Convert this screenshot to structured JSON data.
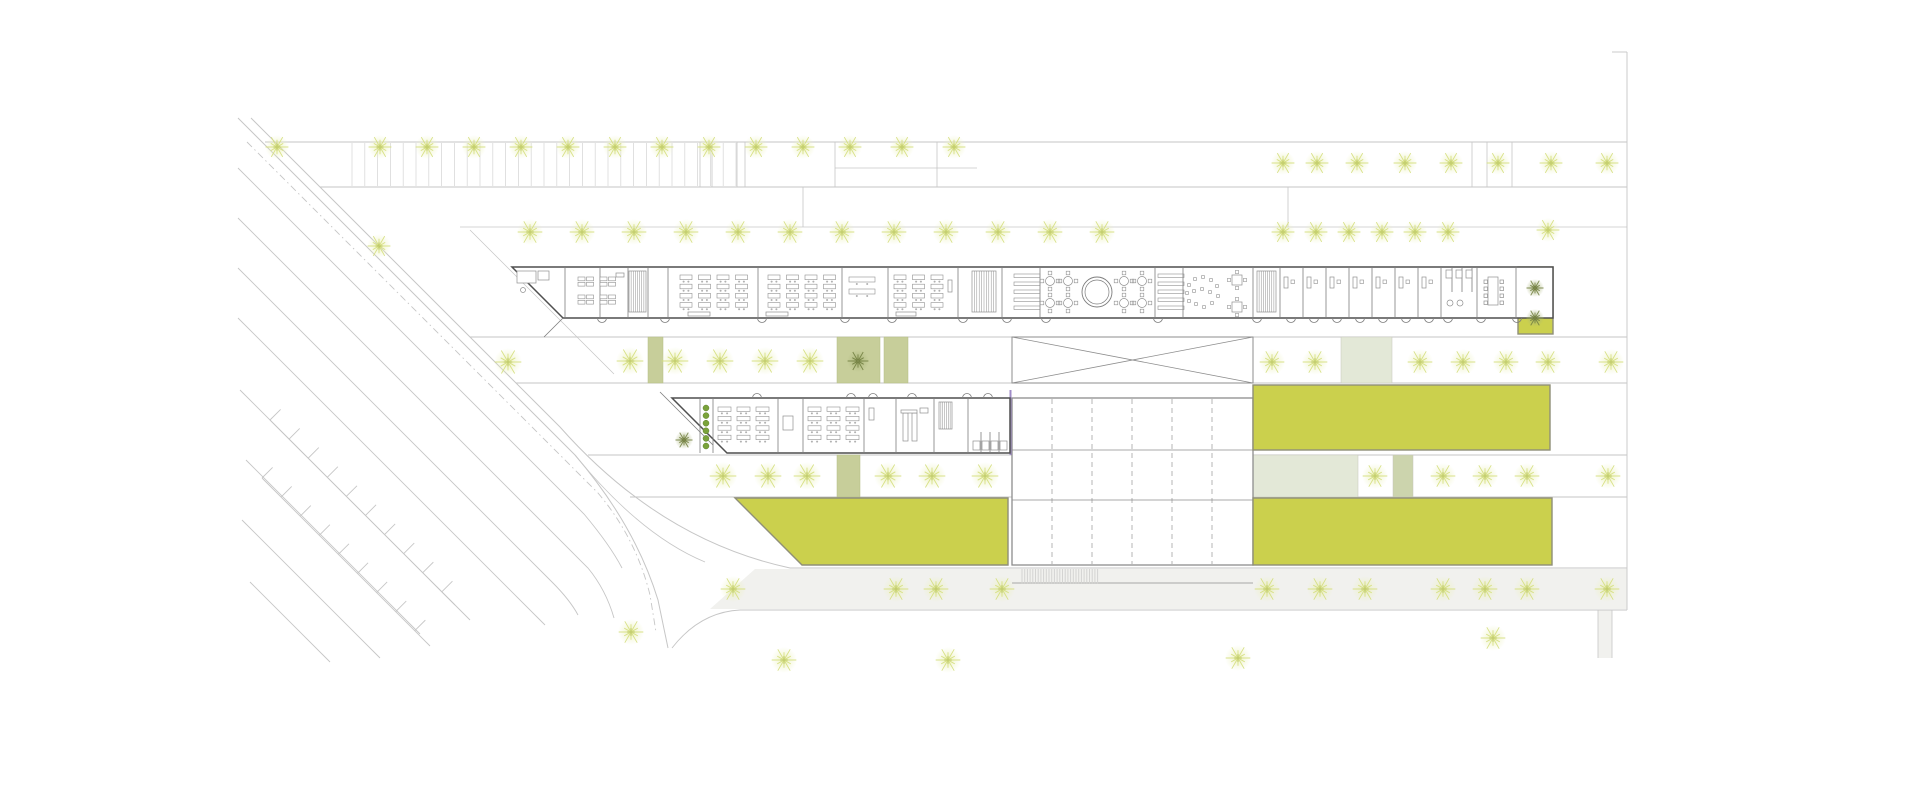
{
  "meta": {
    "canvas": {
      "width": 1920,
      "height": 800
    }
  },
  "palette": {
    "background": "#ffffff",
    "site_line": "#c6c6c6",
    "site_line_light": "#dadada",
    "hatch": "#d9d9d9",
    "crosswalk": "#d4d4d2",
    "wall_dark": "#4f4f4f",
    "wall_mid": "#7d7d7d",
    "furniture": "#8f8f8f",
    "hall_line": "#8d8d8d",
    "yellow_fill": "#cbd04d",
    "yellow_stroke": "#8f8f78",
    "sage_fill": "#c7ce9a",
    "sage_stroke": "#b5bd85",
    "pale_sage_fill": "#e3e8d7",
    "pale_sage_small": "#ccd4ad",
    "tree_light_ray": "#d4de7b",
    "tree_light_core": "#b8c457",
    "tree_dark_ray": "#727f41",
    "planter_dot": "#7aa33a",
    "planter_dot_edge": "#5f7f2c",
    "purple_accent": "#a08cc8",
    "road_band_fill": "#f1f1ee",
    "building_fill": "#ffffff"
  },
  "site": {
    "hlines": [
      [
        265,
        1627,
        142,
        0.9
      ],
      [
        320,
        1627,
        187,
        0.9
      ],
      [
        835,
        977,
        168,
        0.7
      ],
      [
        460,
        1627,
        227,
        0.8
      ],
      [
        470,
        1627,
        337,
        0.9
      ],
      [
        516,
        1627,
        383,
        0.9
      ],
      [
        588,
        1627,
        455,
        0.9
      ],
      [
        630,
        1627,
        497,
        0.9
      ],
      [
        790,
        1627,
        568,
        0.9
      ]
    ],
    "vlines": [
      [
        1627,
        52,
        610,
        0.9
      ],
      [
        700,
        142,
        187,
        0.8
      ],
      [
        712,
        142,
        187,
        0.8
      ],
      [
        737,
        142,
        187,
        0.8
      ],
      [
        745,
        142,
        187,
        0.8
      ],
      [
        835,
        142,
        187,
        0.8
      ],
      [
        937,
        142,
        187,
        0.8
      ],
      [
        1472,
        142,
        187,
        0.8
      ],
      [
        1487,
        142,
        187,
        0.8
      ],
      [
        1512,
        142,
        187,
        0.8
      ],
      [
        803,
        187,
        227,
        0.8
      ],
      [
        1288,
        187,
        227,
        0.8
      ],
      [
        1598,
        610,
        658,
        0.8
      ],
      [
        1612,
        610,
        658,
        0.8
      ]
    ],
    "paths": [
      {
        "d": "M251,118 L560,427 Q660,540 790,568",
        "w": 1.0
      },
      {
        "d": "M238,118 L575,455 Q635,525 658,600 L668,648",
        "w": 1.0
      },
      {
        "d": "M247,142 L598,493 Q636,538 650,595 L656,632",
        "w": 0.9,
        "dash": "7 3.5 1.5 3.5"
      },
      {
        "d": "M238,168 L584,514 Q610,545 622,568",
        "w": 0.9
      },
      {
        "d": "M238,218 L588,568 Q606,590 614,618",
        "w": 0.9
      },
      {
        "d": "M238,268 L552,582 Q570,600 578,615",
        "w": 0.9
      },
      {
        "d": "M238,318 L545,625",
        "w": 0.9
      },
      {
        "d": "M470,230 L614,374",
        "w": 0.7
      },
      {
        "d": "M575,455 Q640,535 705,562",
        "w": 0.8
      },
      {
        "d": "M1627,610 L740,610 Q700,612 672,648",
        "w": 0.9
      },
      {
        "d": "M240,390 L470,620",
        "w": 0.9
      },
      {
        "d": "M246,460 L420,634",
        "w": 0.9
      },
      {
        "d": "M242,520 L380,658",
        "w": 0.9
      },
      {
        "d": "M250,582 L330,662",
        "w": 0.9
      },
      {
        "d": "M1612,52 L1627,52",
        "w": 0.9
      }
    ],
    "tick_spines": [
      {
        "x1": 270,
        "y1": 420,
        "x2": 455,
        "y2": 605,
        "step": 27,
        "len": 15
      },
      {
        "x1": 262,
        "y1": 478,
        "x2": 430,
        "y2": 646,
        "step": 27,
        "len": 15
      }
    ],
    "parking_hatch": {
      "x1": 352,
      "x2": 737,
      "step": 12.8,
      "y1": 143,
      "y2": 186
    },
    "crosswalk": {
      "x1": 1022,
      "x2": 1098,
      "step": 2.7,
      "y1": 569,
      "y2": 584
    },
    "road_band_poly": "755,569 1627,569 1627,609 710,609",
    "side_path": {
      "x": 1598,
      "y": 610,
      "w": 14,
      "h": 48
    }
  },
  "blocks": {
    "sage": [
      {
        "x": 648,
        "y": 337,
        "w": 15,
        "h": 46
      },
      {
        "x": 837,
        "y": 337,
        "w": 43,
        "h": 46
      },
      {
        "x": 884,
        "y": 337,
        "w": 24,
        "h": 46
      },
      {
        "x": 837,
        "y": 455,
        "w": 23,
        "h": 42
      }
    ],
    "pale": [
      {
        "x": 1341,
        "y": 337,
        "w": 51,
        "h": 46,
        "f": "pale_sage_fill"
      },
      {
        "x": 1253,
        "y": 455,
        "w": 105,
        "h": 42,
        "f": "pale_sage_fill"
      },
      {
        "x": 1393,
        "y": 455,
        "w": 20,
        "h": 42,
        "f": "pale_sage_small"
      }
    ],
    "yellow_rects": [
      {
        "name": "lawn-upper-right",
        "x": 1253,
        "y": 385,
        "w": 297,
        "h": 65
      },
      {
        "name": "lawn-lower-right",
        "x": 1253,
        "y": 498,
        "w": 299,
        "h": 67
      },
      {
        "name": "courtyard-upper-east",
        "x": 1518,
        "y": 267,
        "w": 35,
        "h": 67
      }
    ],
    "yellow_polys": [
      {
        "name": "lawn-lower-left",
        "points": "735,498 1008,498 1008,565 802,565"
      }
    ]
  },
  "xramp": {
    "x": 1012,
    "y": 337,
    "w": 241,
    "h": 46
  },
  "hall": {
    "x": 1012,
    "y": 398,
    "w": 241,
    "h": 167,
    "dashed_cols": [
      1052,
      1092,
      1132,
      1172,
      1212
    ],
    "extra_hlines": [
      450,
      500,
      583
    ]
  },
  "purple_line": {
    "x": 1010.5,
    "y1": 390,
    "y2": 455
  },
  "upper_building": {
    "outline": "M512,267 L1553,267 L1553,318 L563,318 Z",
    "porch": "M563,318 L544,337",
    "partitions": [
      [
        565,
        267,
        318
      ],
      [
        600,
        267,
        318
      ],
      [
        628,
        267,
        318
      ],
      [
        648,
        267,
        318
      ],
      [
        668,
        267,
        318
      ],
      [
        758,
        267,
        318
      ],
      [
        842,
        267,
        318
      ],
      [
        888,
        267,
        318
      ],
      [
        958,
        267,
        318
      ],
      [
        1002,
        267,
        318
      ],
      [
        1040,
        267,
        318
      ],
      [
        1155,
        267,
        318
      ],
      [
        1183,
        267,
        318
      ],
      [
        1253,
        267,
        318
      ],
      [
        1280,
        267,
        318
      ],
      [
        1303,
        267,
        318
      ],
      [
        1326,
        267,
        318
      ],
      [
        1349,
        267,
        318
      ],
      [
        1372,
        267,
        318
      ],
      [
        1395,
        267,
        318
      ],
      [
        1418,
        267,
        318
      ],
      [
        1441,
        267,
        318
      ],
      [
        1477,
        267,
        318
      ],
      [
        1516,
        267,
        318
      ],
      [
        1452,
        267,
        292
      ],
      [
        1462,
        267,
        292
      ],
      [
        1472,
        267,
        292
      ]
    ],
    "door_arcs": {
      "y": 318,
      "dir": "down",
      "r": 4.5,
      "xs": [
        602,
        665,
        762,
        845,
        892,
        963,
        1007,
        1046,
        1158,
        1257,
        1291,
        1314,
        1337,
        1360,
        1383,
        1406,
        1429,
        1448,
        1481,
        1517
      ]
    },
    "stairs": [
      [
        629,
        271,
        17,
        41,
        8
      ],
      [
        972,
        271,
        24,
        41,
        10
      ],
      [
        1257,
        271,
        19,
        41,
        9
      ]
    ],
    "hbars": [
      [
        1014,
        274,
        26,
        40,
        5
      ],
      [
        1158,
        274,
        26,
        40,
        5
      ]
    ],
    "deskgrids": [
      [
        680,
        275,
        4,
        4,
        12,
        4.6,
        6.5,
        4.6,
        1
      ],
      [
        768,
        275,
        4,
        4,
        12,
        4.6,
        6.5,
        4.6,
        1
      ],
      [
        894,
        275,
        3,
        4,
        12,
        4.6,
        6.5,
        4.6,
        1
      ],
      [
        578,
        277,
        2,
        2,
        7,
        3.8,
        1.5,
        1.5,
        0
      ],
      [
        600,
        277,
        2,
        2,
        7,
        3.8,
        1.5,
        1.5,
        0
      ],
      [
        578,
        295,
        2,
        2,
        7,
        3.8,
        1.5,
        1.5,
        0
      ],
      [
        600,
        295,
        2,
        2,
        7,
        3.8,
        1.5,
        1.5,
        0
      ],
      [
        849,
        277,
        1,
        2,
        26,
        5,
        0,
        7,
        1
      ]
    ],
    "furn_rects": [
      [
        616,
        273,
        8,
        4
      ],
      [
        688,
        312,
        22,
        4
      ],
      [
        766,
        312,
        22,
        4
      ],
      [
        896,
        312,
        20,
        4
      ],
      [
        948,
        280,
        4,
        12
      ],
      [
        517,
        271,
        19,
        12
      ],
      [
        538,
        271,
        11,
        9
      ],
      [
        1446,
        270,
        6,
        8
      ],
      [
        1456,
        270,
        6,
        8
      ],
      [
        1466,
        270,
        6,
        8
      ],
      [
        1488,
        277,
        10,
        28
      ],
      [
        1484,
        280,
        3.5,
        3.5
      ],
      [
        1484,
        287,
        3.5,
        3.5
      ],
      [
        1484,
        294,
        3.5,
        3.5
      ],
      [
        1484,
        301,
        3.5,
        3.5
      ],
      [
        1500,
        280,
        3.5,
        3.5
      ],
      [
        1500,
        287,
        3.5,
        3.5
      ],
      [
        1500,
        294,
        3.5,
        3.5
      ],
      [
        1500,
        301,
        3.5,
        3.5
      ]
    ],
    "office_desks": {
      "xs": [
        1284,
        1307,
        1330,
        1353,
        1376,
        1399,
        1422
      ],
      "y": 277
    },
    "circles": [
      [
        523,
        290,
        2.5
      ],
      [
        1450,
        303,
        3
      ],
      [
        1460,
        303,
        3
      ]
    ],
    "circle_feature": [
      1097,
      292,
      15,
      12
    ],
    "rtables": [
      [
        1050,
        281
      ],
      [
        1050,
        303
      ],
      [
        1068,
        281
      ],
      [
        1068,
        303
      ],
      [
        1124,
        281
      ],
      [
        1124,
        303
      ],
      [
        1142,
        281
      ],
      [
        1142,
        303
      ]
    ],
    "scatter": {
      "cx": 1203,
      "cy": 293,
      "pts": [
        [
          -14,
          -8
        ],
        [
          -8,
          -14
        ],
        [
          0,
          -16
        ],
        [
          8,
          -13
        ],
        [
          -16,
          0
        ],
        [
          -9,
          -2
        ],
        [
          -1,
          -4
        ],
        [
          7,
          -1
        ],
        [
          -14,
          8
        ],
        [
          -7,
          11
        ],
        [
          1,
          14
        ],
        [
          9,
          10
        ],
        [
          15,
          3
        ],
        [
          14,
          -7
        ]
      ]
    },
    "sqtables": [
      [
        1237,
        280
      ],
      [
        1237,
        307
      ]
    ]
  },
  "lower_building": {
    "outline": "M672,398 L1010,398 L1010,453 L727,453 Z",
    "porch": "M660,392 L713,445",
    "partitions": [
      [
        700,
        398,
        453
      ],
      [
        713,
        398,
        453
      ],
      [
        778,
        398,
        453
      ],
      [
        803,
        398,
        453
      ],
      [
        864,
        398,
        453
      ],
      [
        896,
        398,
        453
      ],
      [
        934,
        398,
        453
      ],
      [
        968,
        398,
        453
      ],
      [
        981,
        432,
        453
      ],
      [
        990,
        432,
        453
      ],
      [
        999,
        432,
        453
      ]
    ],
    "door_arcs": {
      "y": 398,
      "dir": "up",
      "r": 4.5,
      "xs": [
        757,
        851,
        873,
        912,
        967,
        988
      ]
    },
    "stairs": [
      [
        939,
        402,
        13,
        27,
        7
      ]
    ],
    "deskgrids": [
      [
        718,
        407,
        3,
        4,
        13,
        4.4,
        6,
        5,
        1
      ],
      [
        808,
        407,
        3,
        4,
        13,
        4.4,
        6,
        5,
        1
      ]
    ],
    "furn_rects": [
      [
        783,
        416,
        10,
        14
      ],
      [
        869,
        408,
        5,
        12
      ],
      [
        920,
        408,
        8,
        5
      ],
      [
        903,
        413,
        5,
        28
      ],
      [
        912,
        413,
        5,
        28
      ],
      [
        901,
        410,
        16,
        3
      ],
      [
        973,
        441,
        7,
        9
      ],
      [
        982,
        441,
        7,
        9
      ],
      [
        991,
        441,
        7,
        9
      ],
      [
        1000,
        441,
        7,
        9
      ]
    ],
    "office_desks": {
      "xs": [],
      "y": 0
    },
    "circles": [],
    "rtables": [],
    "sqtables": [],
    "hbars": []
  },
  "trees": {
    "light_rows": [
      {
        "y": 147,
        "r": 12,
        "xs": [
          277,
          380,
          427,
          474,
          521,
          568,
          615,
          662,
          709,
          756,
          803,
          850,
          902,
          954
        ]
      },
      {
        "y": 163,
        "r": 12,
        "xs": [
          1283,
          1317,
          1357,
          1405,
          1451,
          1498,
          1551,
          1607
        ]
      },
      {
        "y": 232,
        "r": 13,
        "xs": [
          530,
          582,
          634,
          686,
          738,
          790,
          842,
          894,
          946,
          998,
          1050,
          1102
        ]
      },
      {
        "y": 232,
        "r": 12,
        "xs": [
          1283,
          1316,
          1349,
          1382,
          1415,
          1448
        ]
      },
      {
        "y": 361,
        "r": 14,
        "xs": [
          630,
          675,
          720,
          765,
          810
        ]
      },
      {
        "y": 362,
        "r": 13,
        "xs": [
          1272,
          1315,
          1420,
          1463,
          1506,
          1548,
          1611
        ]
      },
      {
        "y": 476,
        "r": 14,
        "xs": [
          723,
          768,
          807,
          888,
          932,
          985
        ]
      },
      {
        "y": 476,
        "r": 13,
        "xs": [
          1375,
          1443,
          1485,
          1527,
          1608
        ]
      },
      {
        "y": 589,
        "r": 13,
        "xs": [
          733,
          896,
          936,
          1002,
          1267,
          1320,
          1365,
          1443,
          1485,
          1527,
          1607
        ]
      }
    ],
    "light_single": [
      [
        379,
        246,
        12
      ],
      [
        508,
        362,
        14
      ],
      [
        1548,
        230,
        12
      ],
      [
        631,
        632,
        13
      ],
      [
        784,
        660,
        13
      ],
      [
        948,
        660,
        13
      ],
      [
        1238,
        658,
        13
      ],
      [
        1493,
        638,
        13
      ]
    ],
    "dark": [
      [
        858,
        361,
        11
      ],
      [
        684,
        440,
        9
      ],
      [
        1535,
        288,
        9
      ],
      [
        1535,
        318,
        9
      ]
    ],
    "planter_dots": {
      "x": 706,
      "y0": 408,
      "step": 7.6,
      "n": 6,
      "r": 3
    }
  }
}
